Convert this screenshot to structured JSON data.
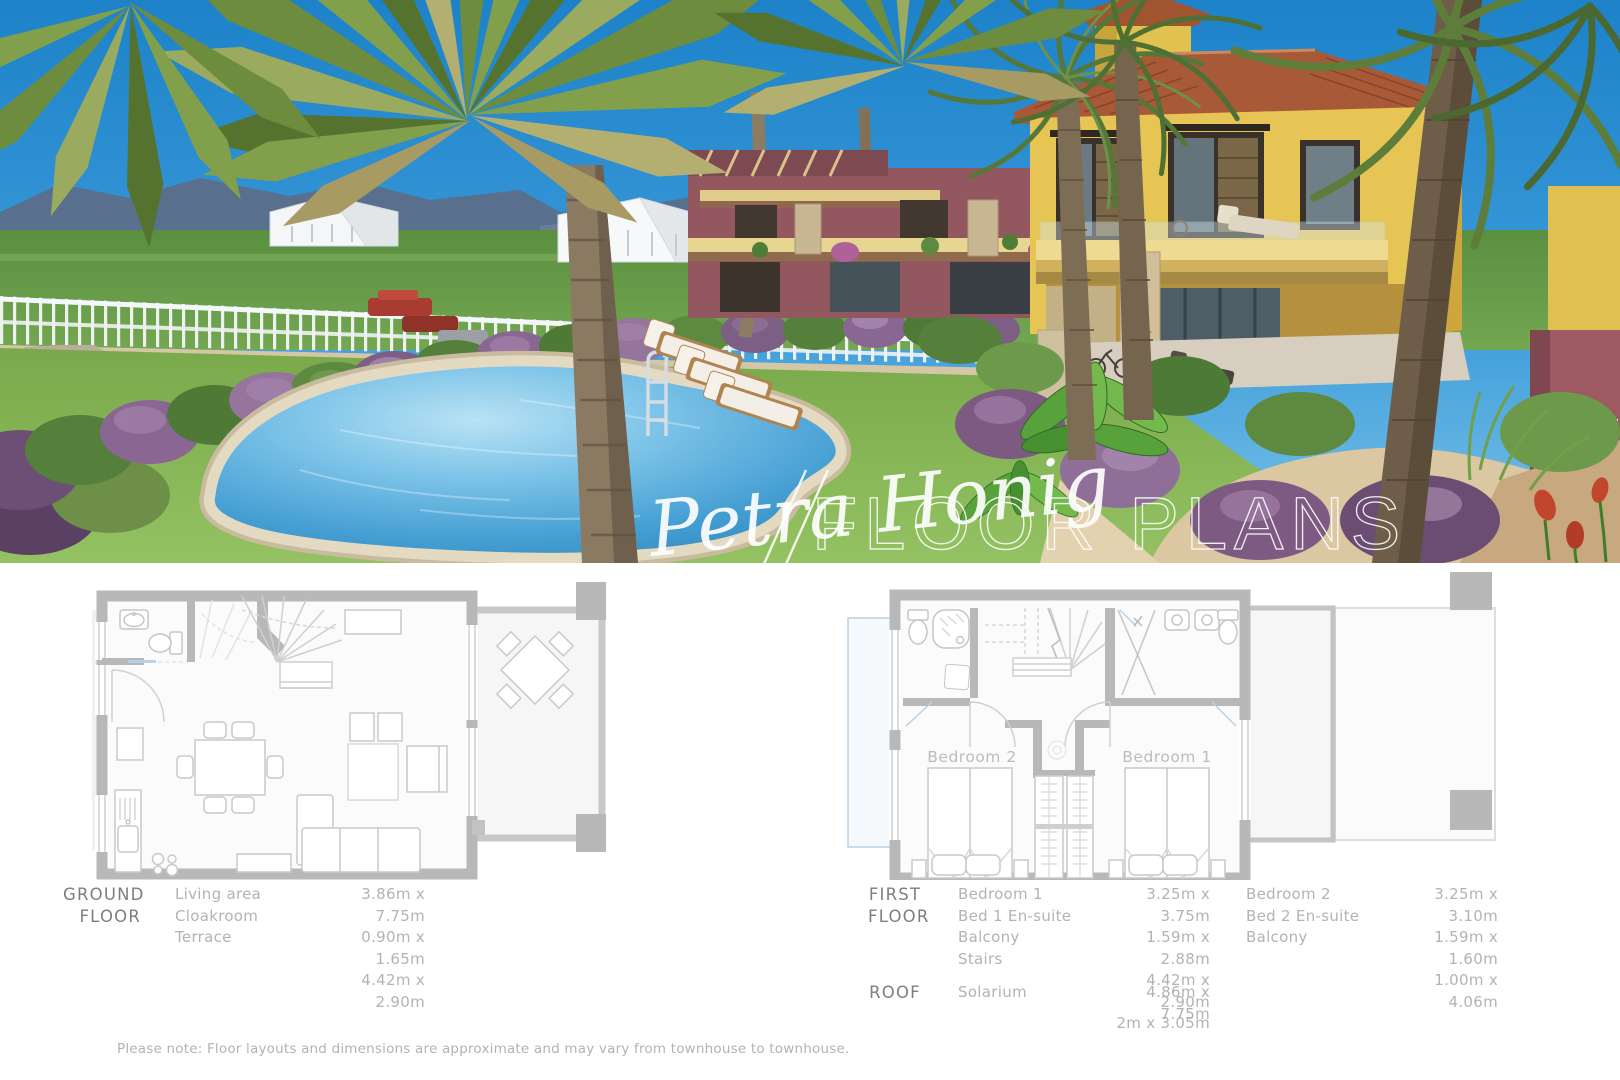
{
  "watermark": {
    "signature": "Petra Honig",
    "title": "FLOOR PLANS"
  },
  "plans": {
    "first": {
      "bedroom1_label": "Bedroom 1",
      "bedroom2_label": "Bedroom 2"
    }
  },
  "tables": {
    "ground": {
      "label_lines": [
        "GROUND",
        "FLOOR"
      ],
      "rows": [
        {
          "name": "Living area",
          "dims": "3.86m x 7.75m"
        },
        {
          "name": "Cloakroom",
          "dims": "0.90m x 1.65m"
        },
        {
          "name": "Terrace",
          "dims": "4.42m x 2.90m"
        }
      ]
    },
    "first": {
      "label_lines": [
        "FIRST",
        "FLOOR"
      ],
      "col1": [
        {
          "name": "Bedroom 1",
          "dims": "3.25m x 3.75m"
        },
        {
          "name": "Bed 1 En-suite",
          "dims": "1.59m x 2.88m"
        },
        {
          "name": "Balcony",
          "dims": "4.42m x 2.90m"
        },
        {
          "name": "Stairs",
          "dims": "2m x 3.05m"
        }
      ],
      "col2": [
        {
          "name": "Bedroom 2",
          "dims": "3.25m x 3.10m"
        },
        {
          "name": "Bed 2 En-suite",
          "dims": "1.59m x 1.60m"
        },
        {
          "name": "Balcony",
          "dims": "1.00m x 4.06m"
        }
      ]
    },
    "roof": {
      "label": "ROOF",
      "rows": [
        {
          "name": "Solarium",
          "dims": "4.86m x 7.75m"
        }
      ]
    }
  },
  "note": {
    "text": "Please note: Floor layouts and dimensions are approximate and may vary from townhouse to townhouse."
  },
  "palette": {
    "sky": "#2a8ed2",
    "pool_water": "#4aa3d8",
    "lawn_green": "#82b052",
    "villa_yellow": "#e3c24f",
    "roof_terracotta": "#a55a3b",
    "hedge_purple": "#8a6793",
    "plan_wall_gray": "#b8b8b8",
    "plan_accent_blue": "#b5d2e8",
    "text_dark": "#7e7e7e",
    "text_light": "#b3b3b3"
  }
}
